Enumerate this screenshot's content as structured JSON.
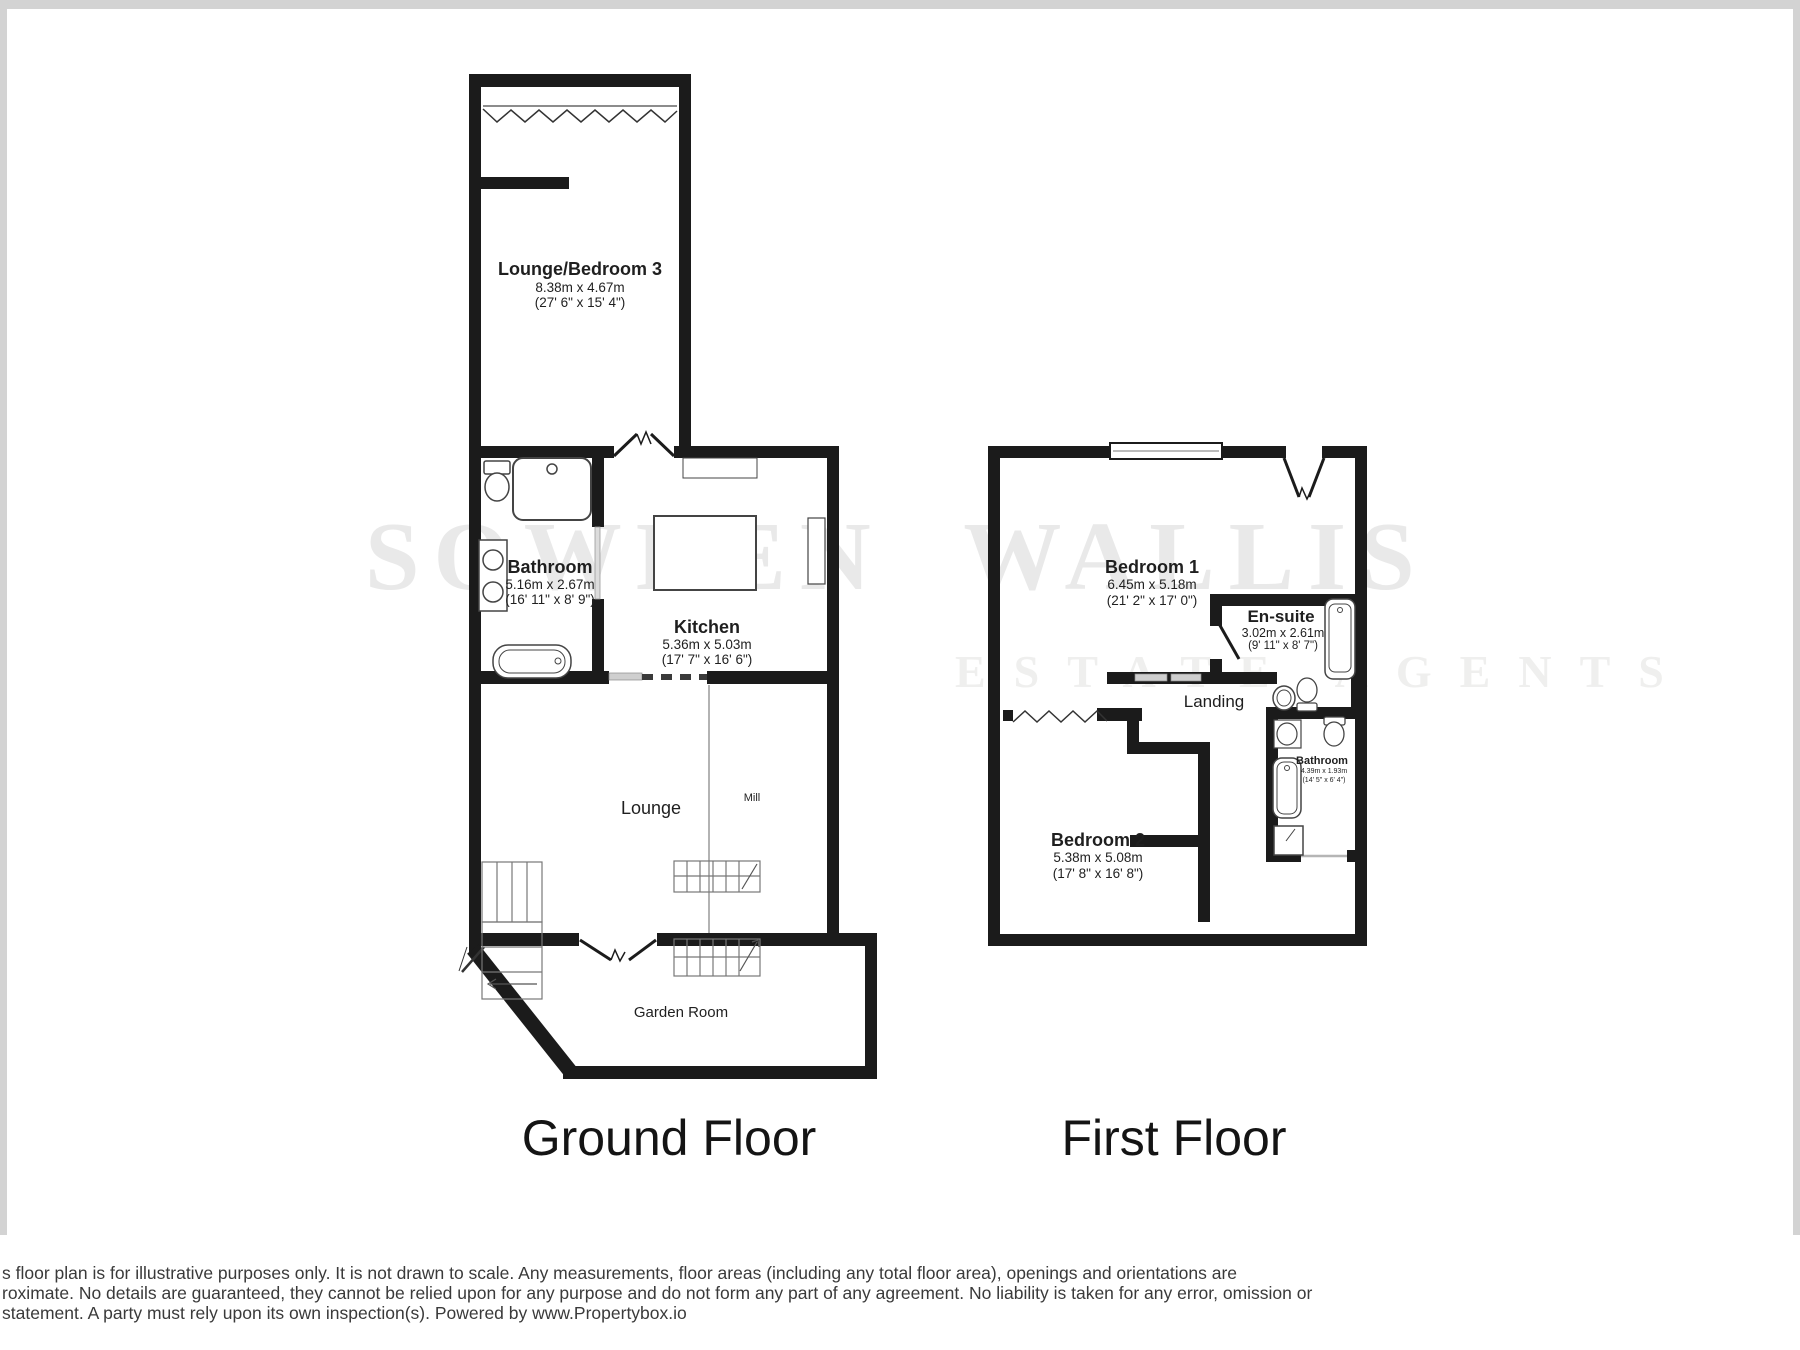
{
  "watermark": {
    "line1": "SOWDEN WALLIS",
    "line2": "ESTATE AGENTS"
  },
  "floors": {
    "ground": {
      "title": "Ground Floor",
      "rooms": {
        "lounge_bedroom3": {
          "name": "Lounge/Bedroom 3",
          "metric": "8.38m x 4.67m",
          "imperial": "(27' 6\" x 15' 4\")"
        },
        "bathroom": {
          "name": "Bathroom",
          "metric": "5.16m x 2.67m",
          "imperial": "(16' 11\" x 8' 9\")"
        },
        "kitchen": {
          "name": "Kitchen",
          "metric": "5.36m x 5.03m",
          "imperial": "(17' 7\" x 16' 6\")"
        },
        "lounge": {
          "name": "Lounge"
        },
        "mill": {
          "name": "Mill"
        },
        "garden_room": {
          "name": "Garden Room"
        }
      }
    },
    "first": {
      "title": "First Floor",
      "rooms": {
        "bedroom1": {
          "name": "Bedroom 1",
          "metric": "6.45m x 5.18m",
          "imperial": "(21' 2\" x 17' 0\")"
        },
        "ensuite": {
          "name": "En-suite",
          "metric": "3.02m x 2.61m",
          "imperial": "(9' 11\" x 8' 7\")"
        },
        "landing": {
          "name": "Landing"
        },
        "bedroom2": {
          "name": "Bedroom 2",
          "metric": "5.38m x 5.08m",
          "imperial": "(17' 8\" x 16' 8\")"
        },
        "bathroom": {
          "name": "Bathroom",
          "metric": "4.39m x 1.93m",
          "imperial": "(14' 5\" x 6' 4\")"
        }
      }
    }
  },
  "disclaimer": {
    "line1": "s floor plan is for illustrative purposes only. It is not drawn to scale. Any measurements, floor areas (including any total floor area), openings and orientations are",
    "line2": "roximate. No details are guaranteed, they cannot be relied upon for any purpose and do not form any part of any agreement. No liability is taken for any error, omission or",
    "line3": "statement. A party must rely upon its own inspection(s). Powered by www.Propertybox.io"
  },
  "colors": {
    "wall": "#1b1b1b",
    "watermark": "#e9e9e9",
    "frame": "#d3d3d3"
  }
}
